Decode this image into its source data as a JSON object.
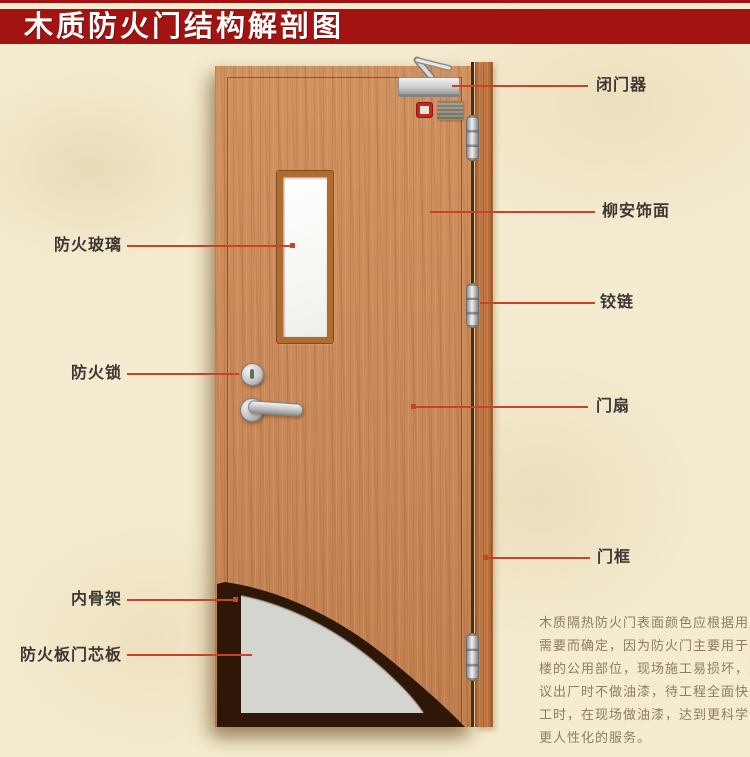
{
  "page": {
    "title": "木质防火门结构解剖图"
  },
  "colors": {
    "accent_red": "#a21311",
    "leader_line": "#c8432a",
    "parchment_bg": "#f4ebd0",
    "door_wood": "#c8885a",
    "frame_wood": "#b06a38",
    "skeleton_dark": "#2f1708",
    "core_gray": "#d5d5cf"
  },
  "callouts": {
    "door_closer": "闭门器",
    "lauan_veneer": "柳安饰面",
    "hinge": "铰链",
    "door_leaf": "门扇",
    "door_frame": "门框",
    "fire_glass": "防火玻璃",
    "fire_lock": "防火锁",
    "inner_skeleton": "内骨架",
    "fire_board_core": "防火板门芯板"
  },
  "note": {
    "lines": [
      "木质隔热防火门表面颜色应根据用户",
      "需要而确定，因为防火门主要用于大",
      "楼的公用部位，现场施工易损坏，建",
      "议出厂时不做油漆，待工程全面快完",
      "工时，在现场做油漆，达到更科学化",
      "更人性化的服务。"
    ]
  }
}
